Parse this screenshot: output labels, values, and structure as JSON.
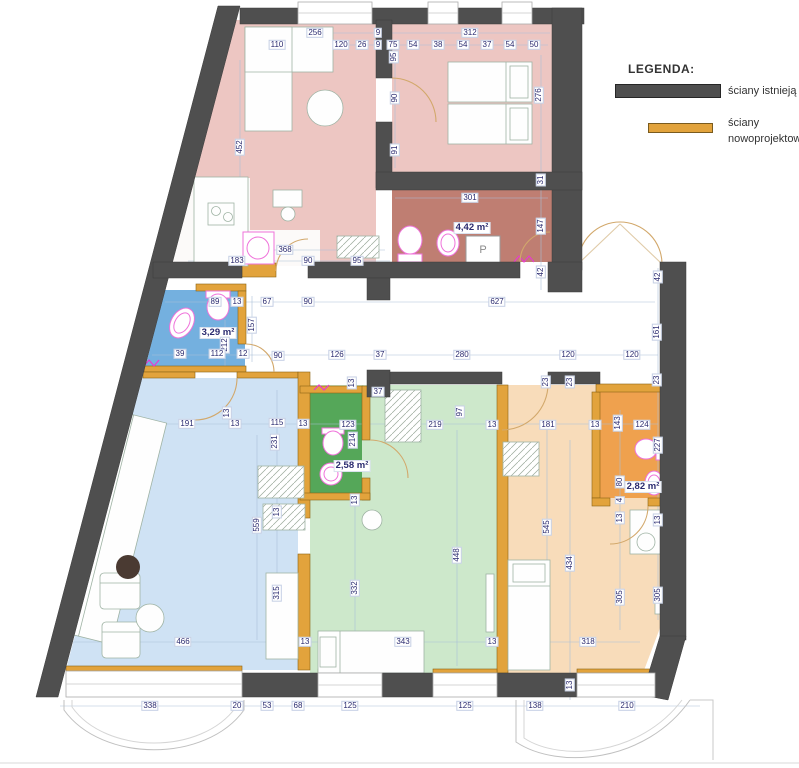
{
  "legend": {
    "title": "LEGENDA:",
    "items": [
      {
        "label": "ściany istnieją",
        "color": "#4f4f4f"
      },
      {
        "label": "ściany nowoprojektow",
        "color": "#e2a33c"
      }
    ]
  },
  "colors": {
    "wall_existing": "#4f4f4f",
    "wall_new": "#e2a33c",
    "room_pink": "#edc6c2",
    "bathroom_red": "#bf7e72",
    "bathroom_blue": "#74b0df",
    "room_blue": "#cfe2f4",
    "bathroom_green": "#55a759",
    "room_green": "#cde8cb",
    "bathroom_orange": "#efa14e",
    "room_orange": "#f8dcba",
    "sanitary_outline": "#ef72da",
    "dimension_text": "#2b2b70"
  },
  "plan": {
    "labels": [
      {
        "t": "256",
        "x": 315,
        "y": 33,
        "o": "h"
      },
      {
        "t": "110",
        "x": 277,
        "y": 45,
        "o": "h"
      },
      {
        "t": "120",
        "x": 341,
        "y": 45,
        "o": "h"
      },
      {
        "t": "26",
        "x": 362,
        "y": 45,
        "o": "h"
      },
      {
        "t": "9",
        "x": 378,
        "y": 33,
        "o": "h"
      },
      {
        "t": "9",
        "x": 378,
        "y": 45,
        "o": "h"
      },
      {
        "t": "75",
        "x": 393,
        "y": 45,
        "o": "h"
      },
      {
        "t": "312",
        "x": 470,
        "y": 33,
        "o": "h"
      },
      {
        "t": "54",
        "x": 413,
        "y": 45,
        "o": "h"
      },
      {
        "t": "38",
        "x": 438,
        "y": 45,
        "o": "h"
      },
      {
        "t": "54",
        "x": 463,
        "y": 45,
        "o": "h"
      },
      {
        "t": "37",
        "x": 487,
        "y": 45,
        "o": "h"
      },
      {
        "t": "54",
        "x": 510,
        "y": 45,
        "o": "h"
      },
      {
        "t": "50",
        "x": 534,
        "y": 45,
        "o": "h"
      },
      {
        "t": "95",
        "x": 394,
        "y": 57,
        "o": "v"
      },
      {
        "t": "90",
        "x": 395,
        "y": 98,
        "o": "v"
      },
      {
        "t": "91",
        "x": 395,
        "y": 150,
        "o": "v"
      },
      {
        "t": "452",
        "x": 240,
        "y": 147,
        "o": "v"
      },
      {
        "t": "276",
        "x": 539,
        "y": 95,
        "o": "v"
      },
      {
        "t": "31",
        "x": 541,
        "y": 180,
        "o": "v"
      },
      {
        "t": "301",
        "x": 470,
        "y": 198,
        "o": "h"
      },
      {
        "t": "4,42 m²",
        "x": 472,
        "y": 228,
        "o": "h",
        "k": "area"
      },
      {
        "t": "147",
        "x": 541,
        "y": 226,
        "o": "v"
      },
      {
        "t": "42",
        "x": 541,
        "y": 272,
        "o": "v"
      },
      {
        "t": "P",
        "x": 483,
        "y": 251,
        "o": "h",
        "k": "app"
      },
      {
        "t": "368",
        "x": 285,
        "y": 250,
        "o": "h"
      },
      {
        "t": "183",
        "x": 237,
        "y": 261,
        "o": "h"
      },
      {
        "t": "90",
        "x": 308,
        "y": 261,
        "o": "h"
      },
      {
        "t": "95",
        "x": 357,
        "y": 261,
        "o": "h"
      },
      {
        "t": "89",
        "x": 215,
        "y": 302,
        "o": "h"
      },
      {
        "t": "13",
        "x": 237,
        "y": 302,
        "o": "h"
      },
      {
        "t": "67",
        "x": 267,
        "y": 302,
        "o": "h"
      },
      {
        "t": "90",
        "x": 308,
        "y": 302,
        "o": "h"
      },
      {
        "t": "627",
        "x": 497,
        "y": 302,
        "o": "h"
      },
      {
        "t": "42",
        "x": 658,
        "y": 277,
        "o": "v"
      },
      {
        "t": "161",
        "x": 657,
        "y": 332,
        "o": "v"
      },
      {
        "t": "157",
        "x": 252,
        "y": 325,
        "o": "v"
      },
      {
        "t": "3,29 m²",
        "x": 218,
        "y": 333,
        "o": "h",
        "k": "area"
      },
      {
        "t": "212",
        "x": 225,
        "y": 345,
        "o": "v"
      },
      {
        "t": "39",
        "x": 180,
        "y": 354,
        "o": "h"
      },
      {
        "t": "112",
        "x": 217,
        "y": 354,
        "o": "h"
      },
      {
        "t": "12",
        "x": 243,
        "y": 354,
        "o": "h"
      },
      {
        "t": "90",
        "x": 278,
        "y": 356,
        "o": "h"
      },
      {
        "t": "126",
        "x": 337,
        "y": 355,
        "o": "h"
      },
      {
        "t": "37",
        "x": 380,
        "y": 355,
        "o": "h"
      },
      {
        "t": "280",
        "x": 462,
        "y": 355,
        "o": "h"
      },
      {
        "t": "120",
        "x": 568,
        "y": 355,
        "o": "h"
      },
      {
        "t": "120",
        "x": 632,
        "y": 355,
        "o": "h"
      },
      {
        "t": "23",
        "x": 546,
        "y": 382,
        "o": "v"
      },
      {
        "t": "23",
        "x": 570,
        "y": 382,
        "o": "v"
      },
      {
        "t": "23",
        "x": 657,
        "y": 380,
        "o": "v"
      },
      {
        "t": "37",
        "x": 378,
        "y": 392,
        "o": "h"
      },
      {
        "t": "13",
        "x": 352,
        "y": 383,
        "o": "v"
      },
      {
        "t": "191",
        "x": 187,
        "y": 424,
        "o": "h"
      },
      {
        "t": "13",
        "x": 227,
        "y": 413,
        "o": "v"
      },
      {
        "t": "13",
        "x": 235,
        "y": 424,
        "o": "h"
      },
      {
        "t": "115",
        "x": 277,
        "y": 423,
        "o": "h"
      },
      {
        "t": "13",
        "x": 303,
        "y": 424,
        "o": "h"
      },
      {
        "t": "123",
        "x": 348,
        "y": 425,
        "o": "h"
      },
      {
        "t": "214",
        "x": 353,
        "y": 440,
        "o": "v"
      },
      {
        "t": "2,58 m²",
        "x": 352,
        "y": 466,
        "o": "h",
        "k": "area"
      },
      {
        "t": "13",
        "x": 355,
        "y": 500,
        "o": "v"
      },
      {
        "t": "97",
        "x": 460,
        "y": 412,
        "o": "v"
      },
      {
        "t": "219",
        "x": 435,
        "y": 425,
        "o": "h"
      },
      {
        "t": "13",
        "x": 492,
        "y": 425,
        "o": "h"
      },
      {
        "t": "181",
        "x": 548,
        "y": 425,
        "o": "h"
      },
      {
        "t": "13",
        "x": 595,
        "y": 425,
        "o": "h"
      },
      {
        "t": "143",
        "x": 618,
        "y": 423,
        "o": "v"
      },
      {
        "t": "124",
        "x": 642,
        "y": 425,
        "o": "h"
      },
      {
        "t": "227",
        "x": 658,
        "y": 445,
        "o": "v"
      },
      {
        "t": "80",
        "x": 620,
        "y": 482,
        "o": "v"
      },
      {
        "t": "2,82 m²",
        "x": 643,
        "y": 487,
        "o": "h",
        "k": "area"
      },
      {
        "t": "4",
        "x": 620,
        "y": 500,
        "o": "v"
      },
      {
        "t": "13",
        "x": 620,
        "y": 518,
        "o": "v"
      },
      {
        "t": "13",
        "x": 658,
        "y": 520,
        "o": "v"
      },
      {
        "t": "231",
        "x": 275,
        "y": 442,
        "o": "v"
      },
      {
        "t": "13",
        "x": 277,
        "y": 512,
        "o": "v"
      },
      {
        "t": "559",
        "x": 257,
        "y": 525,
        "o": "v"
      },
      {
        "t": "315",
        "x": 277,
        "y": 593,
        "o": "v"
      },
      {
        "t": "332",
        "x": 355,
        "y": 588,
        "o": "v"
      },
      {
        "t": "448",
        "x": 457,
        "y": 555,
        "o": "v"
      },
      {
        "t": "545",
        "x": 547,
        "y": 527,
        "o": "v"
      },
      {
        "t": "434",
        "x": 570,
        "y": 563,
        "o": "v"
      },
      {
        "t": "305",
        "x": 620,
        "y": 597,
        "o": "v"
      },
      {
        "t": "305",
        "x": 658,
        "y": 595,
        "o": "v"
      },
      {
        "t": "466",
        "x": 183,
        "y": 642,
        "o": "h"
      },
      {
        "t": "13",
        "x": 305,
        "y": 642,
        "o": "h"
      },
      {
        "t": "343",
        "x": 403,
        "y": 642,
        "o": "h"
      },
      {
        "t": "13",
        "x": 492,
        "y": 642,
        "o": "h"
      },
      {
        "t": "318",
        "x": 588,
        "y": 642,
        "o": "h"
      },
      {
        "t": "13",
        "x": 570,
        "y": 685,
        "o": "v"
      },
      {
        "t": "338",
        "x": 150,
        "y": 706,
        "o": "h"
      },
      {
        "t": "20",
        "x": 237,
        "y": 706,
        "o": "h"
      },
      {
        "t": "53",
        "x": 267,
        "y": 706,
        "o": "h"
      },
      {
        "t": "68",
        "x": 298,
        "y": 706,
        "o": "h"
      },
      {
        "t": "125",
        "x": 350,
        "y": 706,
        "o": "h"
      },
      {
        "t": "125",
        "x": 465,
        "y": 706,
        "o": "h"
      },
      {
        "t": "138",
        "x": 535,
        "y": 706,
        "o": "h"
      },
      {
        "t": "210",
        "x": 627,
        "y": 706,
        "o": "h"
      }
    ]
  }
}
